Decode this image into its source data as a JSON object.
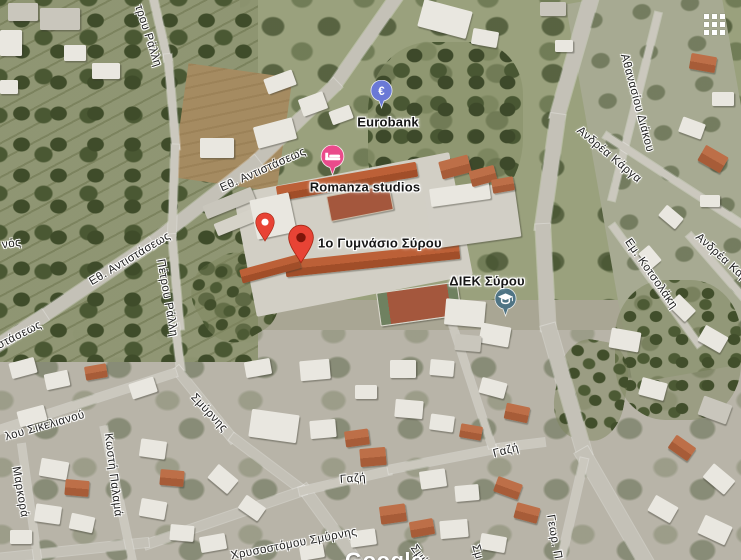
{
  "attribution": {
    "watermark": "Google"
  },
  "glyphs": {
    "euro": "€"
  },
  "pin_colors": {
    "eurobank": "#6a79d6",
    "romanza": "#ea4b8b",
    "red": "#e84335",
    "diek": "#4f7484"
  },
  "places": [
    {
      "name": "Eurobank",
      "icon": "euro-pin"
    },
    {
      "name": "Romanza studios",
      "icon": "bed-pin"
    },
    {
      "name": "1ο Γυμνάσιο Σύρου",
      "icon": "red-pin"
    },
    {
      "name": "ΔΙΕΚ Σύρου",
      "icon": "graduation-pin"
    }
  ],
  "streets": [
    {
      "text": "τρου Ράλλη"
    },
    {
      "text": "Εθ. Αντιστάσεως"
    },
    {
      "text": "Εθ. Αντιστάσεως"
    },
    {
      "text": "ιστάσεως"
    },
    {
      "text": "νός"
    },
    {
      "text": "Πέτρου Ράλλη"
    },
    {
      "text": "Αθανασίου Διάκου"
    },
    {
      "text": "Ανδρέα Κάργα"
    },
    {
      "text": "Ανδρέα Κάρ"
    },
    {
      "text": "Εμ. Κοτσολάκη"
    },
    {
      "text": "λου Σικελιανού"
    },
    {
      "text": "Μαρκορά"
    },
    {
      "text": "Κωστή Παλαμά"
    },
    {
      "text": "Σμύρνης"
    },
    {
      "text": "Γαζή"
    },
    {
      "text": "Γαζή"
    },
    {
      "text": "Χρυσοστόμου Σμύρνης"
    },
    {
      "text": "Σμύ"
    },
    {
      "text": "Σμ"
    },
    {
      "text": "Γεωρ. Π"
    }
  ]
}
